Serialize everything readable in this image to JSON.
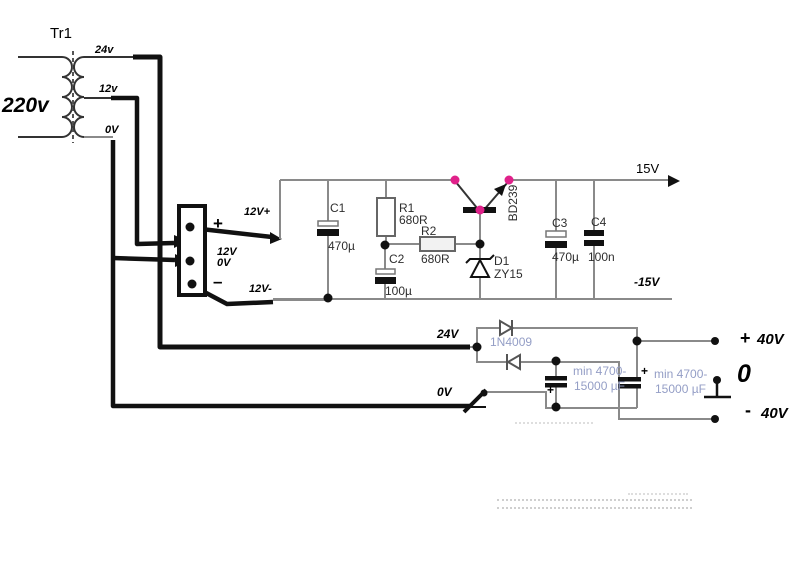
{
  "diagram": {
    "transformer": {
      "name": "Tr1",
      "primary_voltage": "220v",
      "tap_24": "24v",
      "tap_12": "12v",
      "tap_0": "0V"
    },
    "terminal_block": {
      "plus": "+",
      "minus": "–",
      "mid_line1": "12V",
      "mid_line2": "0V",
      "out_plus": "12V+",
      "out_minus": "12V-"
    },
    "regulator": {
      "c1": {
        "ref": "C1",
        "value": "470µ"
      },
      "r1": {
        "ref": "R1",
        "value": "680R"
      },
      "r2": {
        "ref": "R2",
        "value": "680R"
      },
      "c2": {
        "ref": "C2",
        "value": "100µ"
      },
      "q1": {
        "ref": "BD239"
      },
      "d1": {
        "ref": "D1",
        "value": "ZY15"
      },
      "c3": {
        "ref": "C3",
        "value": "470µ"
      },
      "c4": {
        "ref": "C4",
        "value": "100n"
      },
      "rail_pos": "15V",
      "rail_neg": "-15V"
    },
    "rectifier": {
      "in_24": "24V",
      "in_0": "0V",
      "diode_type": "1N4009",
      "cap1_plus": "+",
      "cap2_plus": "+",
      "cap1_note": [
        "min 4700-",
        "15000 µF"
      ],
      "cap2_note": [
        "min 4700-",
        "15000 µF"
      ],
      "out_pos_sign": "+",
      "out_pos": "40V",
      "out_zero": "0",
      "out_neg_sign": "-",
      "out_neg": "40V"
    },
    "colors": {
      "highlight_dot": "#e0218a",
      "wire_gray": "#8a8a8a",
      "wire_thick": "#111111",
      "note_text": "#949ec6"
    }
  }
}
